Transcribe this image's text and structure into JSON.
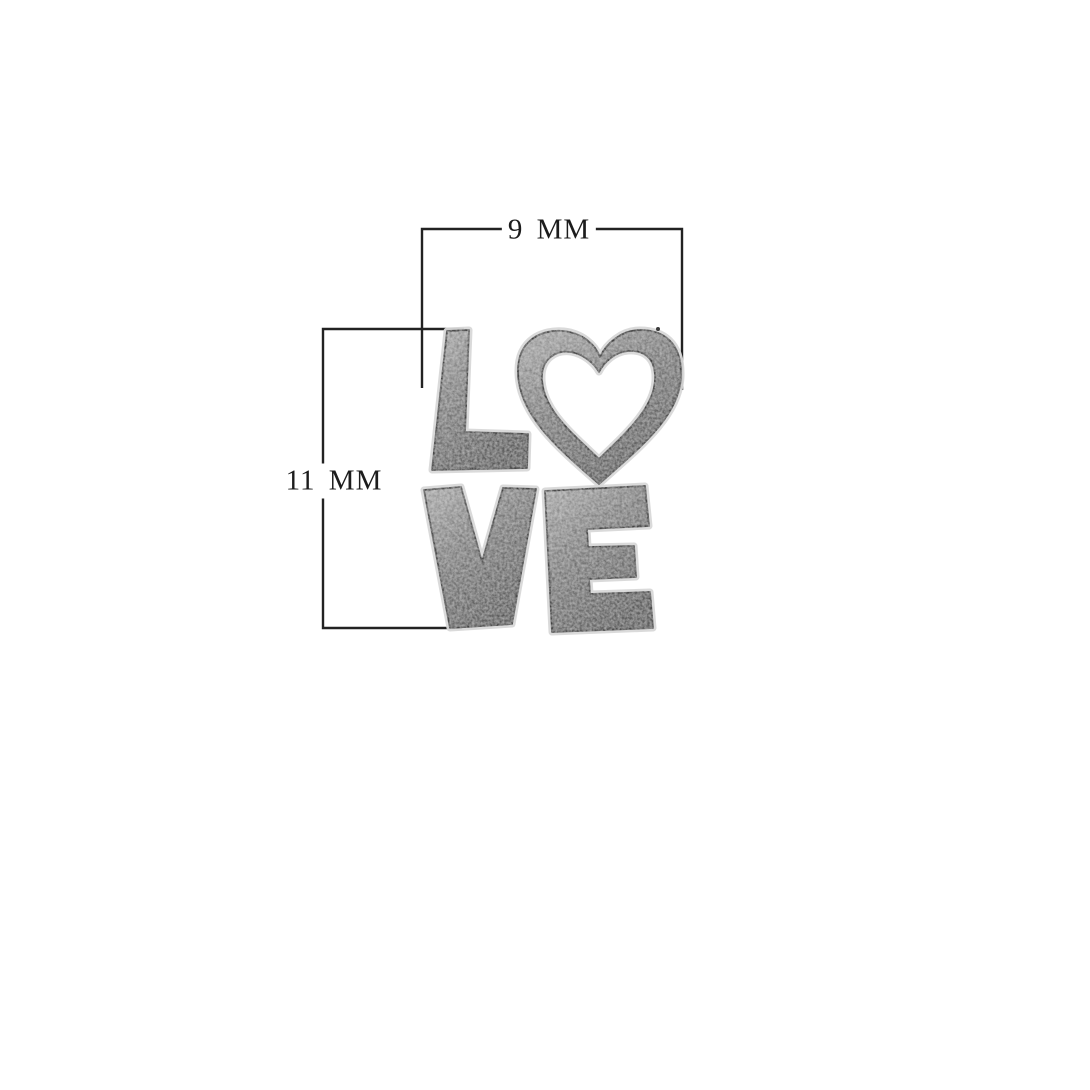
{
  "figure": {
    "type": "product dimension photo",
    "subject": "Silver LOVE charm, stacked letters with an open heart as the letter O",
    "background_color": "#ffffff"
  },
  "dimensions": {
    "width_label": "9 MM",
    "height_label": "11 MM"
  },
  "charm": {
    "word": "LOVE",
    "letters": [
      "L",
      "heart",
      "V",
      "E"
    ]
  },
  "colors": {
    "dimension_line": "#222222",
    "label_text": "#1c1c1c",
    "silver_highlight": "#d8d8d8",
    "silver_light": "#c3c3c3",
    "silver_mid": "#949494",
    "silver_dark": "#6e6e6e",
    "edge_shadow": "#4f4f4f"
  }
}
